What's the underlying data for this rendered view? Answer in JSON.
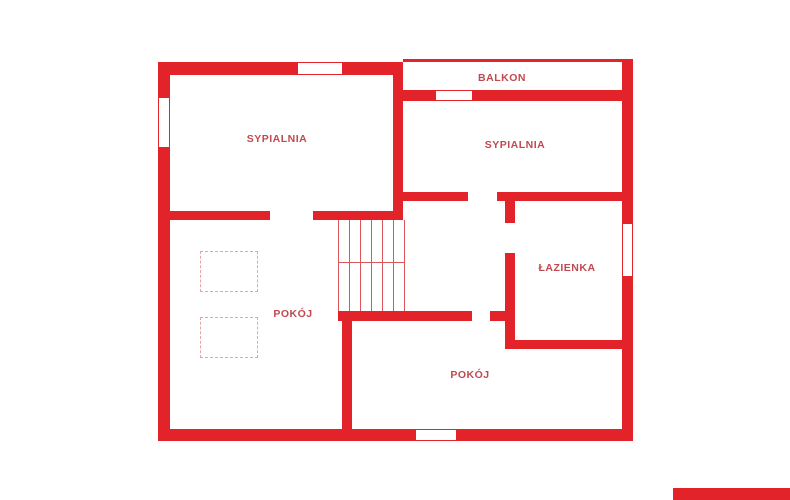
{
  "colors": {
    "wall_red": "#e2242a",
    "label_red": "#c0494f",
    "stair_red": "#d9565a",
    "furniture_pink": "#e3a6a8"
  },
  "rooms": {
    "sypialnia_left": {
      "label": "SYPIALNIA"
    },
    "balkon": {
      "label": "BALKON"
    },
    "sypialnia_right": {
      "label": "SYPIALNIA"
    },
    "lazienka": {
      "label": "ŁAZIENKA"
    },
    "pokoj_left": {
      "label": "POKÓJ"
    },
    "pokoj_bottom": {
      "label": "POKÓJ"
    }
  }
}
